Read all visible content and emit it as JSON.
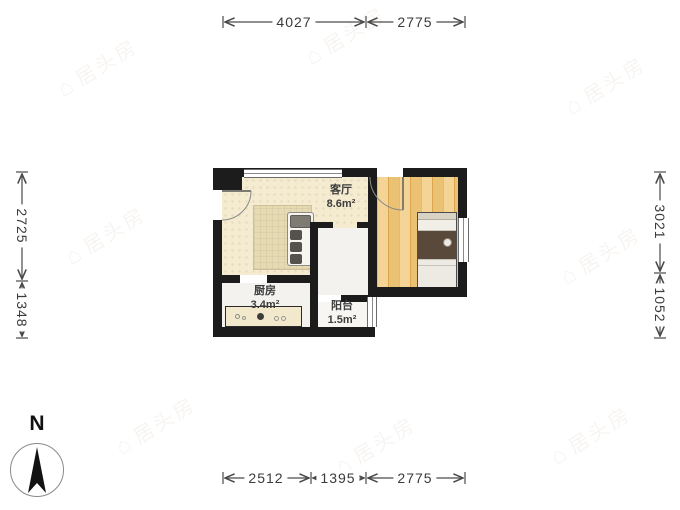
{
  "plan": {
    "rooms": [
      {
        "name": "客厅",
        "area": "8.6m²"
      },
      {
        "name": "厨房",
        "area": "3.4m²"
      },
      {
        "name": "阳台",
        "area": "1.5m²"
      }
    ]
  },
  "dims": {
    "top": [
      {
        "label": "4027"
      },
      {
        "label": "2775"
      }
    ],
    "bottom": [
      {
        "label": "2512"
      },
      {
        "label": "1395"
      },
      {
        "label": "2775"
      }
    ],
    "left": [
      {
        "label": "2725"
      },
      {
        "label": "1348"
      }
    ],
    "right": [
      {
        "label": "3021"
      },
      {
        "label": "1052"
      }
    ]
  },
  "compass": {
    "label": "N"
  },
  "watermark": {
    "logo": "⌂",
    "text": "居头房"
  },
  "colors": {
    "wall": "#1c1c1c",
    "living_floor": "#f4ebd0",
    "wood_floor": "#f2ca7c",
    "dimension": "#4a4a4a"
  }
}
